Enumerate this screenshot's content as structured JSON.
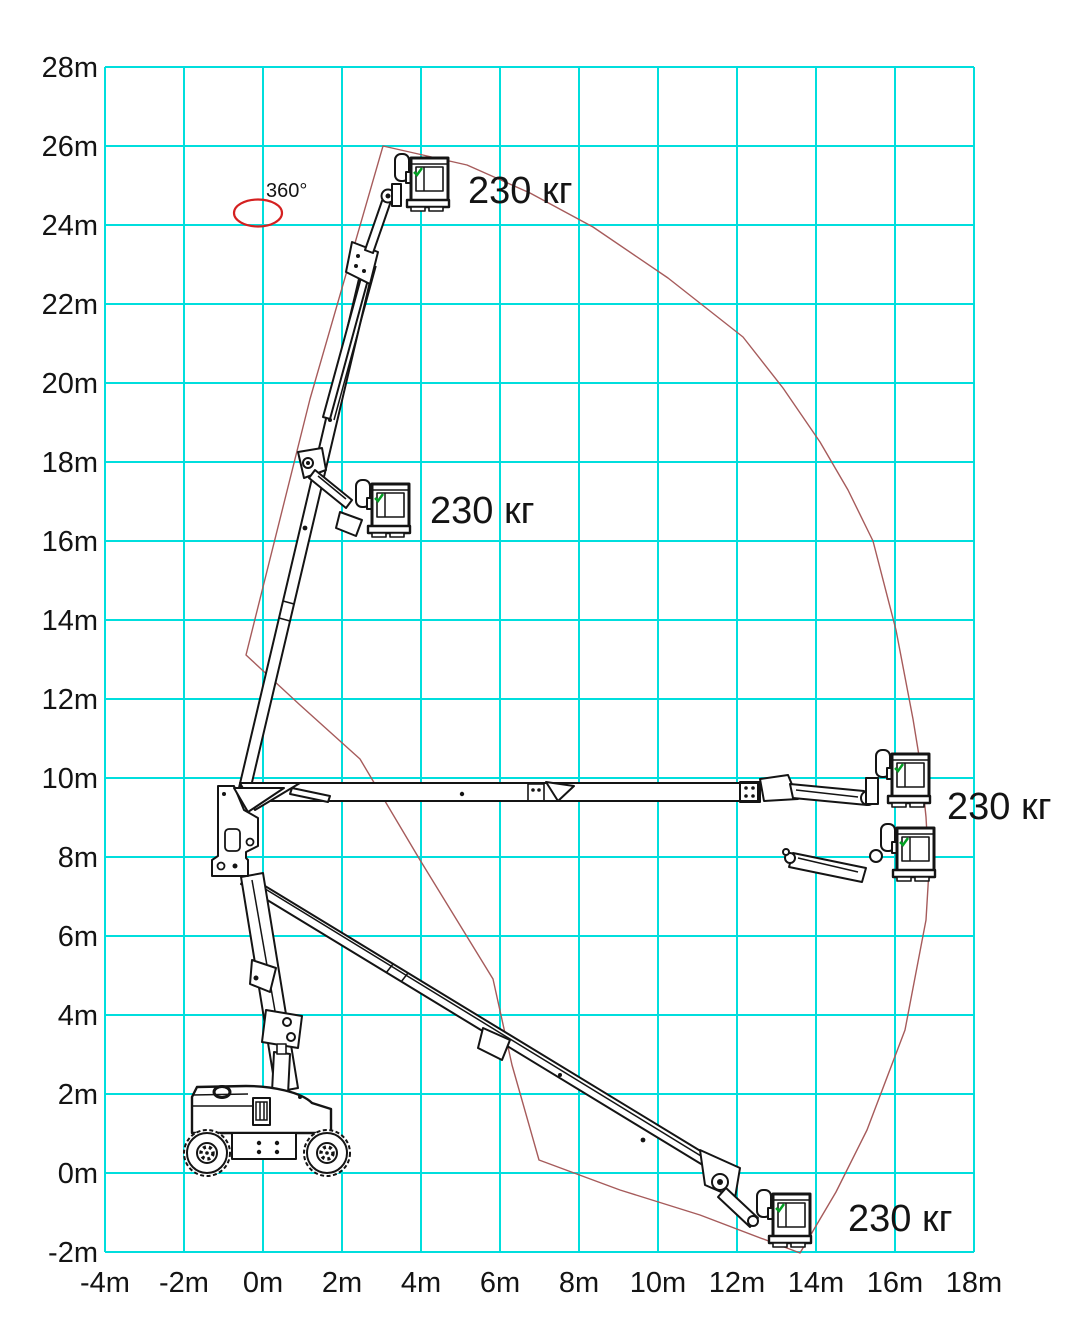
{
  "axes": {
    "unit": "m",
    "x_labels": [
      "-4m",
      "-2m",
      "0m",
      "2m",
      "4m",
      "6m",
      "8m",
      "10m",
      "12m",
      "14m",
      "16m",
      "18m"
    ],
    "y_labels": [
      "28m",
      "26m",
      "24m",
      "22m",
      "20m",
      "18m",
      "16m",
      "14m",
      "12m",
      "10m",
      "8m",
      "6m",
      "4m",
      "2m",
      "0m",
      "-2m"
    ]
  },
  "annotations": {
    "rotation_label": "360°",
    "capacity_labels": [
      {
        "text": "230 кг",
        "position": "top"
      },
      {
        "text": "230 кг",
        "position": "upper-left"
      },
      {
        "text": "230 кг",
        "position": "right"
      },
      {
        "text": "230 кг",
        "position": "bottom"
      }
    ]
  },
  "chart_data": {
    "type": "area",
    "title": "",
    "xlabel": "",
    "ylabel": "",
    "x_range": [
      -4,
      18
    ],
    "y_range": [
      -2,
      28
    ],
    "x_tick_step": 2,
    "y_tick_step": 2,
    "grid": true,
    "platform_capacity_kg": 230,
    "slew_rotation_deg": 360,
    "envelope_points_m": [
      [
        3.0,
        26.0
      ],
      [
        5.2,
        25.5
      ],
      [
        8.4,
        23.9
      ],
      [
        12.2,
        21.2
      ],
      [
        14.1,
        18.5
      ],
      [
        15.4,
        16.0
      ],
      [
        16.5,
        11.5
      ],
      [
        16.8,
        9.0
      ],
      [
        16.8,
        6.4
      ],
      [
        15.3,
        1.1
      ],
      [
        13.6,
        -2.0
      ],
      [
        11.1,
        -1.1
      ],
      [
        7.0,
        0.3
      ],
      [
        5.8,
        4.9
      ],
      [
        2.5,
        10.5
      ],
      [
        -0.4,
        13.1
      ],
      [
        1.2,
        19.6
      ]
    ],
    "platform_positions_m": [
      {
        "x": 4.0,
        "y": 25.0,
        "capacity_kg": 230
      },
      {
        "x": 3.2,
        "y": 16.6,
        "capacity_kg": 230
      },
      {
        "x": 16.0,
        "y": 9.9,
        "capacity_kg": 230
      },
      {
        "x": 16.0,
        "y": 8.2,
        "capacity_kg": 230
      },
      {
        "x": 13.0,
        "y": -1.0,
        "capacity_kg": 230
      }
    ]
  },
  "colors": {
    "background": "#ffffff",
    "grid": "#00dedd",
    "envelope": "#a65b5b",
    "rotation_ellipse": "#d42020",
    "machine_lines": "#141414",
    "platform_marker_green": "#00a021"
  }
}
